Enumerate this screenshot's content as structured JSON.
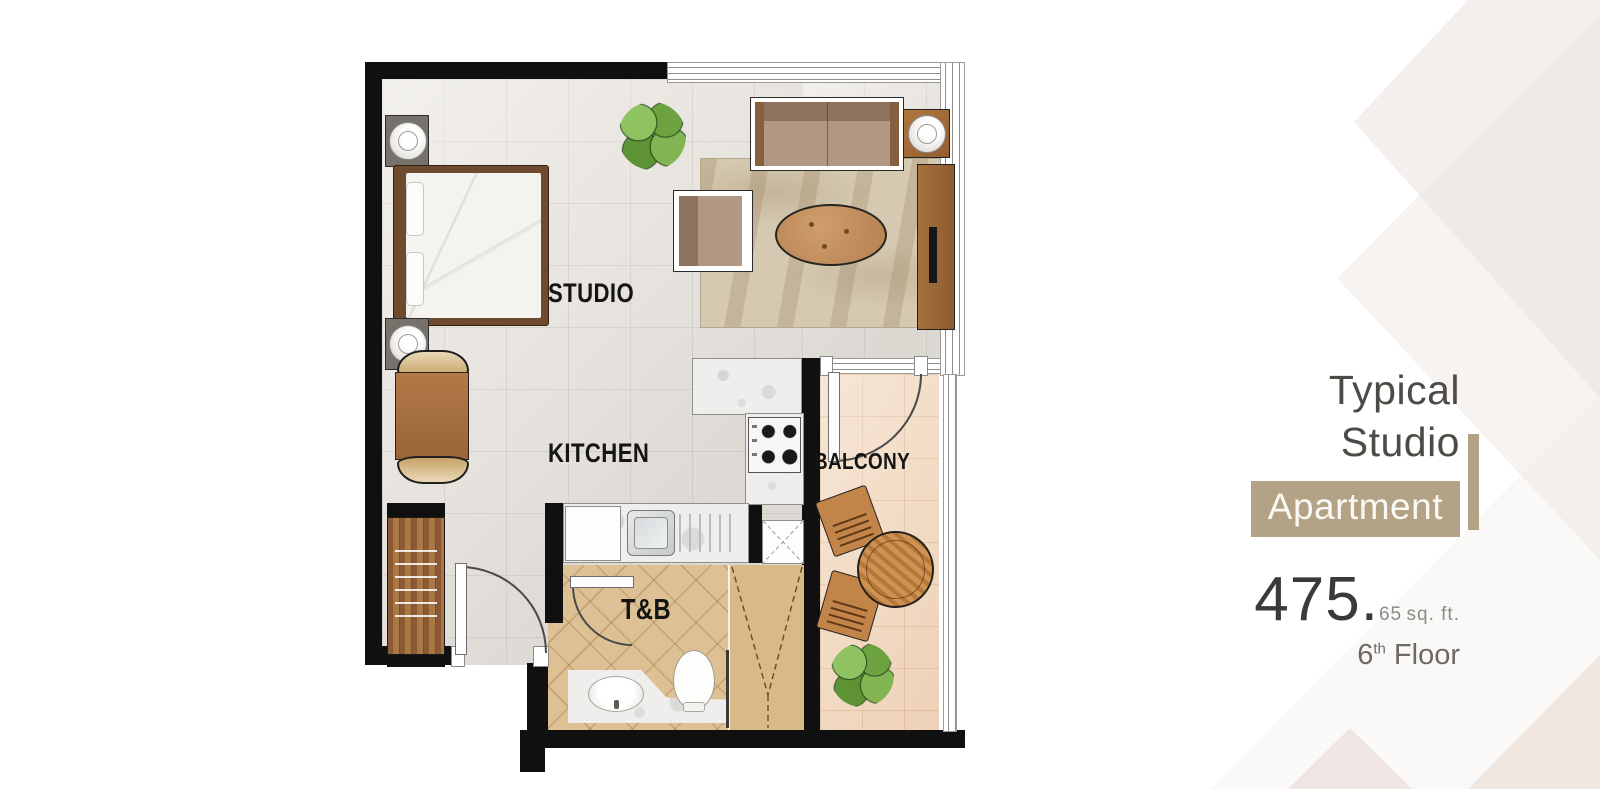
{
  "panel": {
    "title_line1": "Typical",
    "title_line2": "Studio",
    "badge": "Apartment",
    "area_whole": "475.",
    "area_fraction": "65",
    "area_unit": "sq. ft.",
    "floor_number": "6",
    "floor_suffix": "th",
    "floor_word": "Floor"
  },
  "plan": {
    "labels": {
      "studio": "STUDIO",
      "kitchen": "KITCHEN",
      "balcony": "BALCONY",
      "tnb": "T&B"
    },
    "furniture": [
      "bed",
      "nightstand",
      "table-lamp",
      "dining-table",
      "dining-chair",
      "wardrobe",
      "sofa",
      "armchair",
      "coffee-table",
      "side-table",
      "tv-console",
      "rug",
      "potted-plant",
      "stove",
      "kitchen-sink",
      "fridge",
      "storage-cabinet",
      "toilet",
      "vanity-basin",
      "shower",
      "balcony-table",
      "balcony-chair"
    ]
  },
  "colors": {
    "accent_tan": "#b3a286",
    "wall_black": "#101010",
    "floor_tile": "#e8e4df",
    "balcony_tile": "#f2d9c1",
    "bath_tile": "#ddc194",
    "rug": "#d5cab1",
    "wood": "#a9713f",
    "plant_green": "#76ad47"
  }
}
